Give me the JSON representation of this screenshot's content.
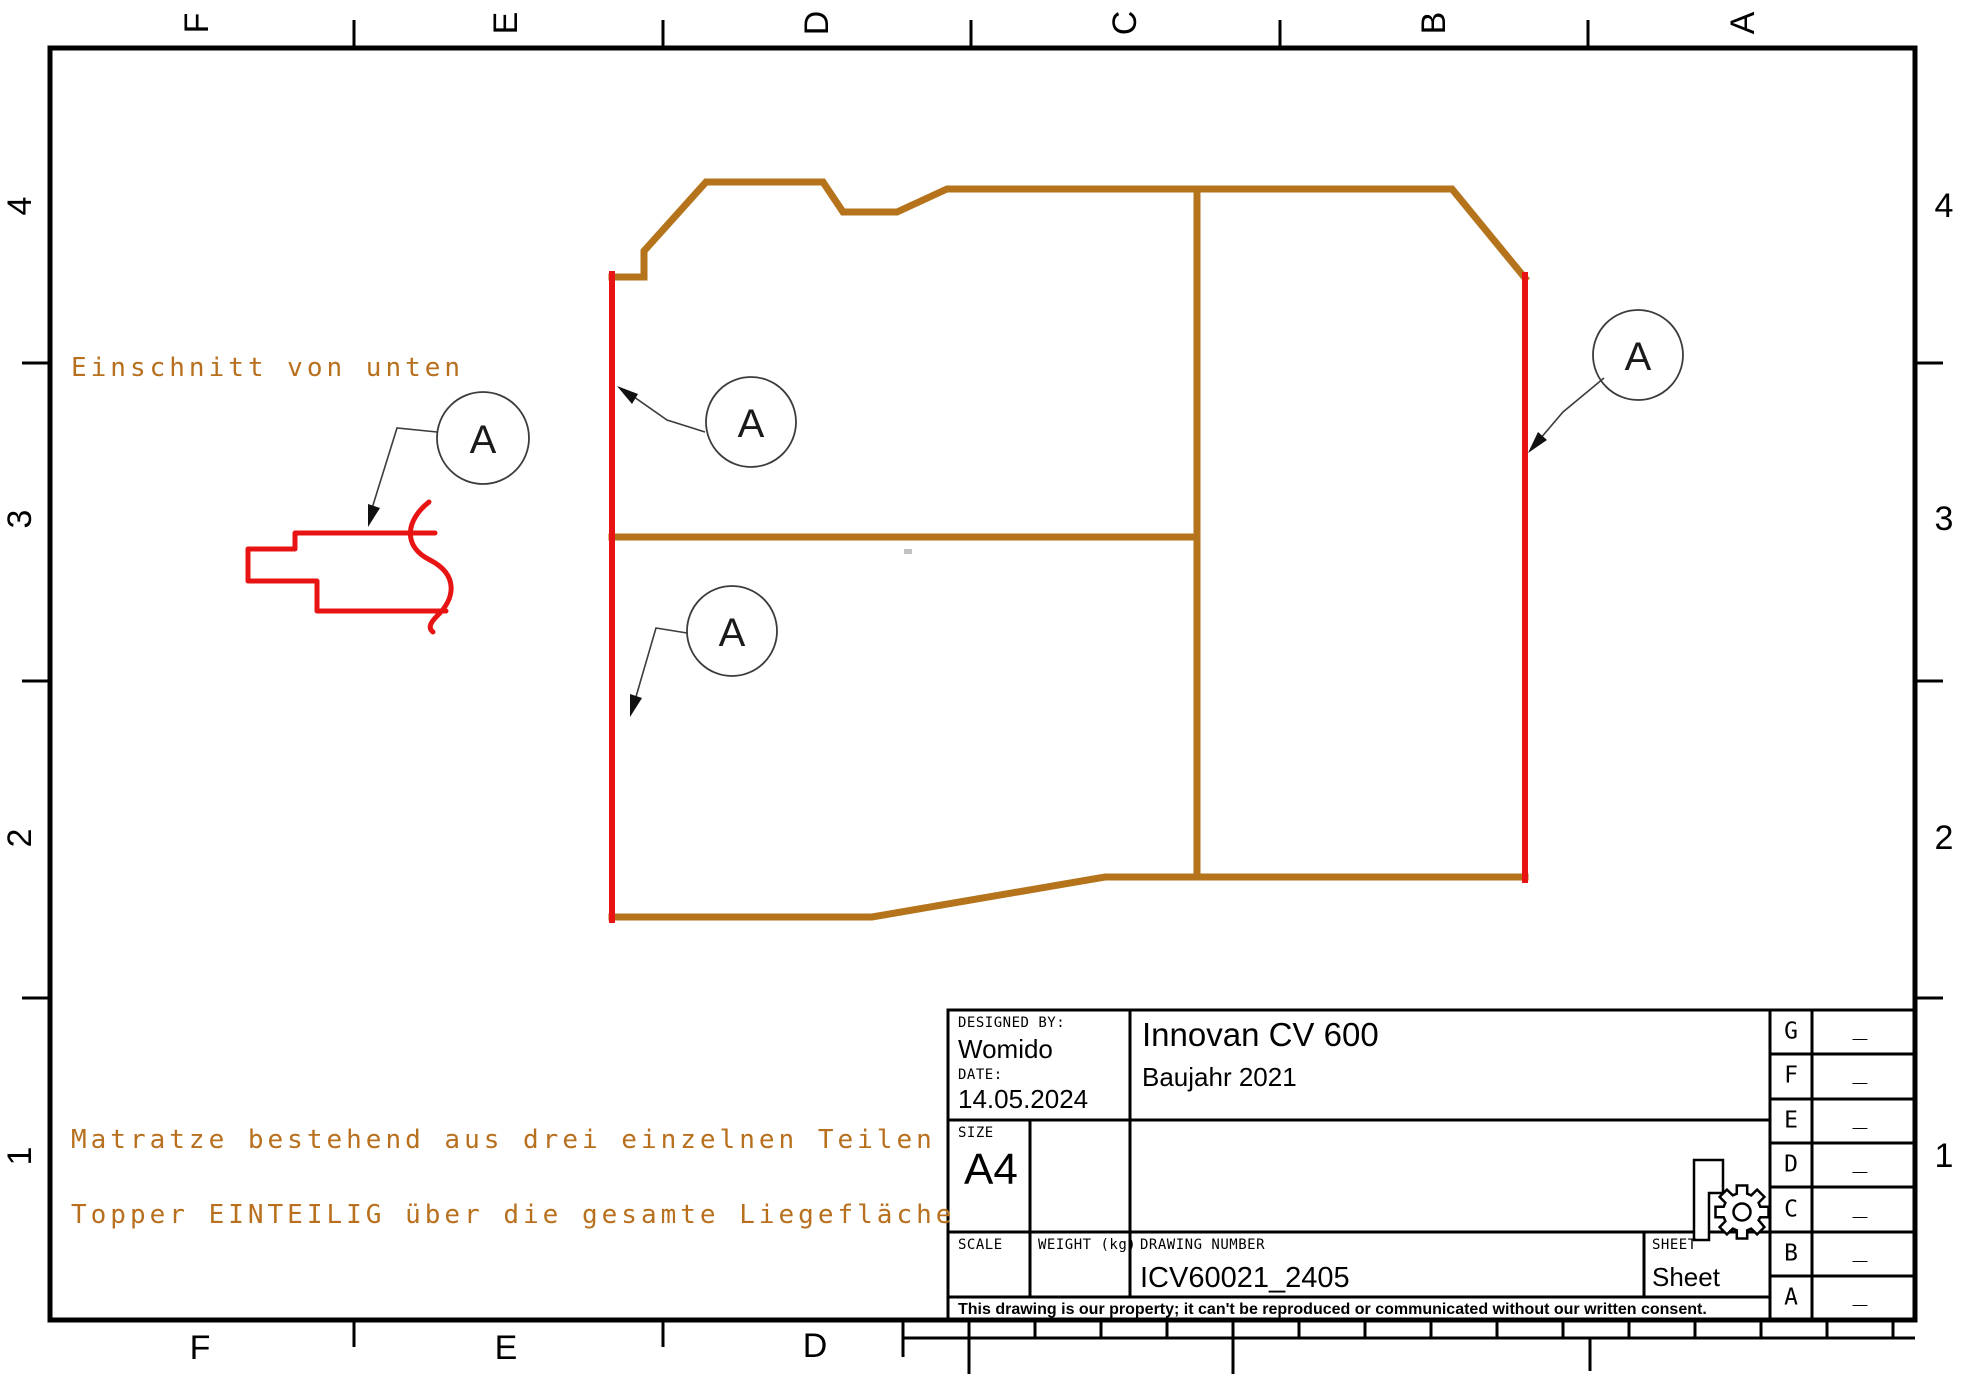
{
  "colors": {
    "brown": "#B5731C",
    "red": "#E81414",
    "orange": "#B8701E"
  },
  "frame": {
    "top_letters": [
      "F",
      "E",
      "D",
      "C",
      "B",
      "A"
    ],
    "bottom_letters": [
      "F",
      "E",
      "D"
    ],
    "left_numbers": [
      "4",
      "3",
      "2",
      "1"
    ],
    "right_numbers": [
      "4",
      "3",
      "2",
      "1"
    ]
  },
  "annotations": {
    "balloon_label": "A",
    "detail_note": "Einschnitt von unten",
    "note_line1": "Matratze bestehend aus drei einzelnen Teilen",
    "note_line2": "Topper EINTEILIG über die gesamte Liegefläche"
  },
  "title_block": {
    "designed_by_label": "DESIGNED BY:",
    "designed_by": "Womido",
    "date_label": "DATE:",
    "date": "14.05.2024",
    "size_label": "SIZE",
    "size": "A4",
    "scale_label": "SCALE",
    "weight_label": "WEIGHT (kg)",
    "drawing_number_label": "DRAWING NUMBER",
    "drawing_number": "ICV60021_2405",
    "sheet_label": "SHEET",
    "sheet": "Sheet",
    "title": "Innovan CV 600",
    "subtitle": "Baujahr 2021",
    "disclaimer": "This drawing is our property; it can't be reproduced or communicated without our written consent.",
    "revision_rows": [
      {
        "letter": "G",
        "value": "_"
      },
      {
        "letter": "F",
        "value": "_"
      },
      {
        "letter": "E",
        "value": "_"
      },
      {
        "letter": "D",
        "value": "_"
      },
      {
        "letter": "C",
        "value": "_"
      },
      {
        "letter": "B",
        "value": "_"
      },
      {
        "letter": "A",
        "value": "_"
      }
    ]
  }
}
